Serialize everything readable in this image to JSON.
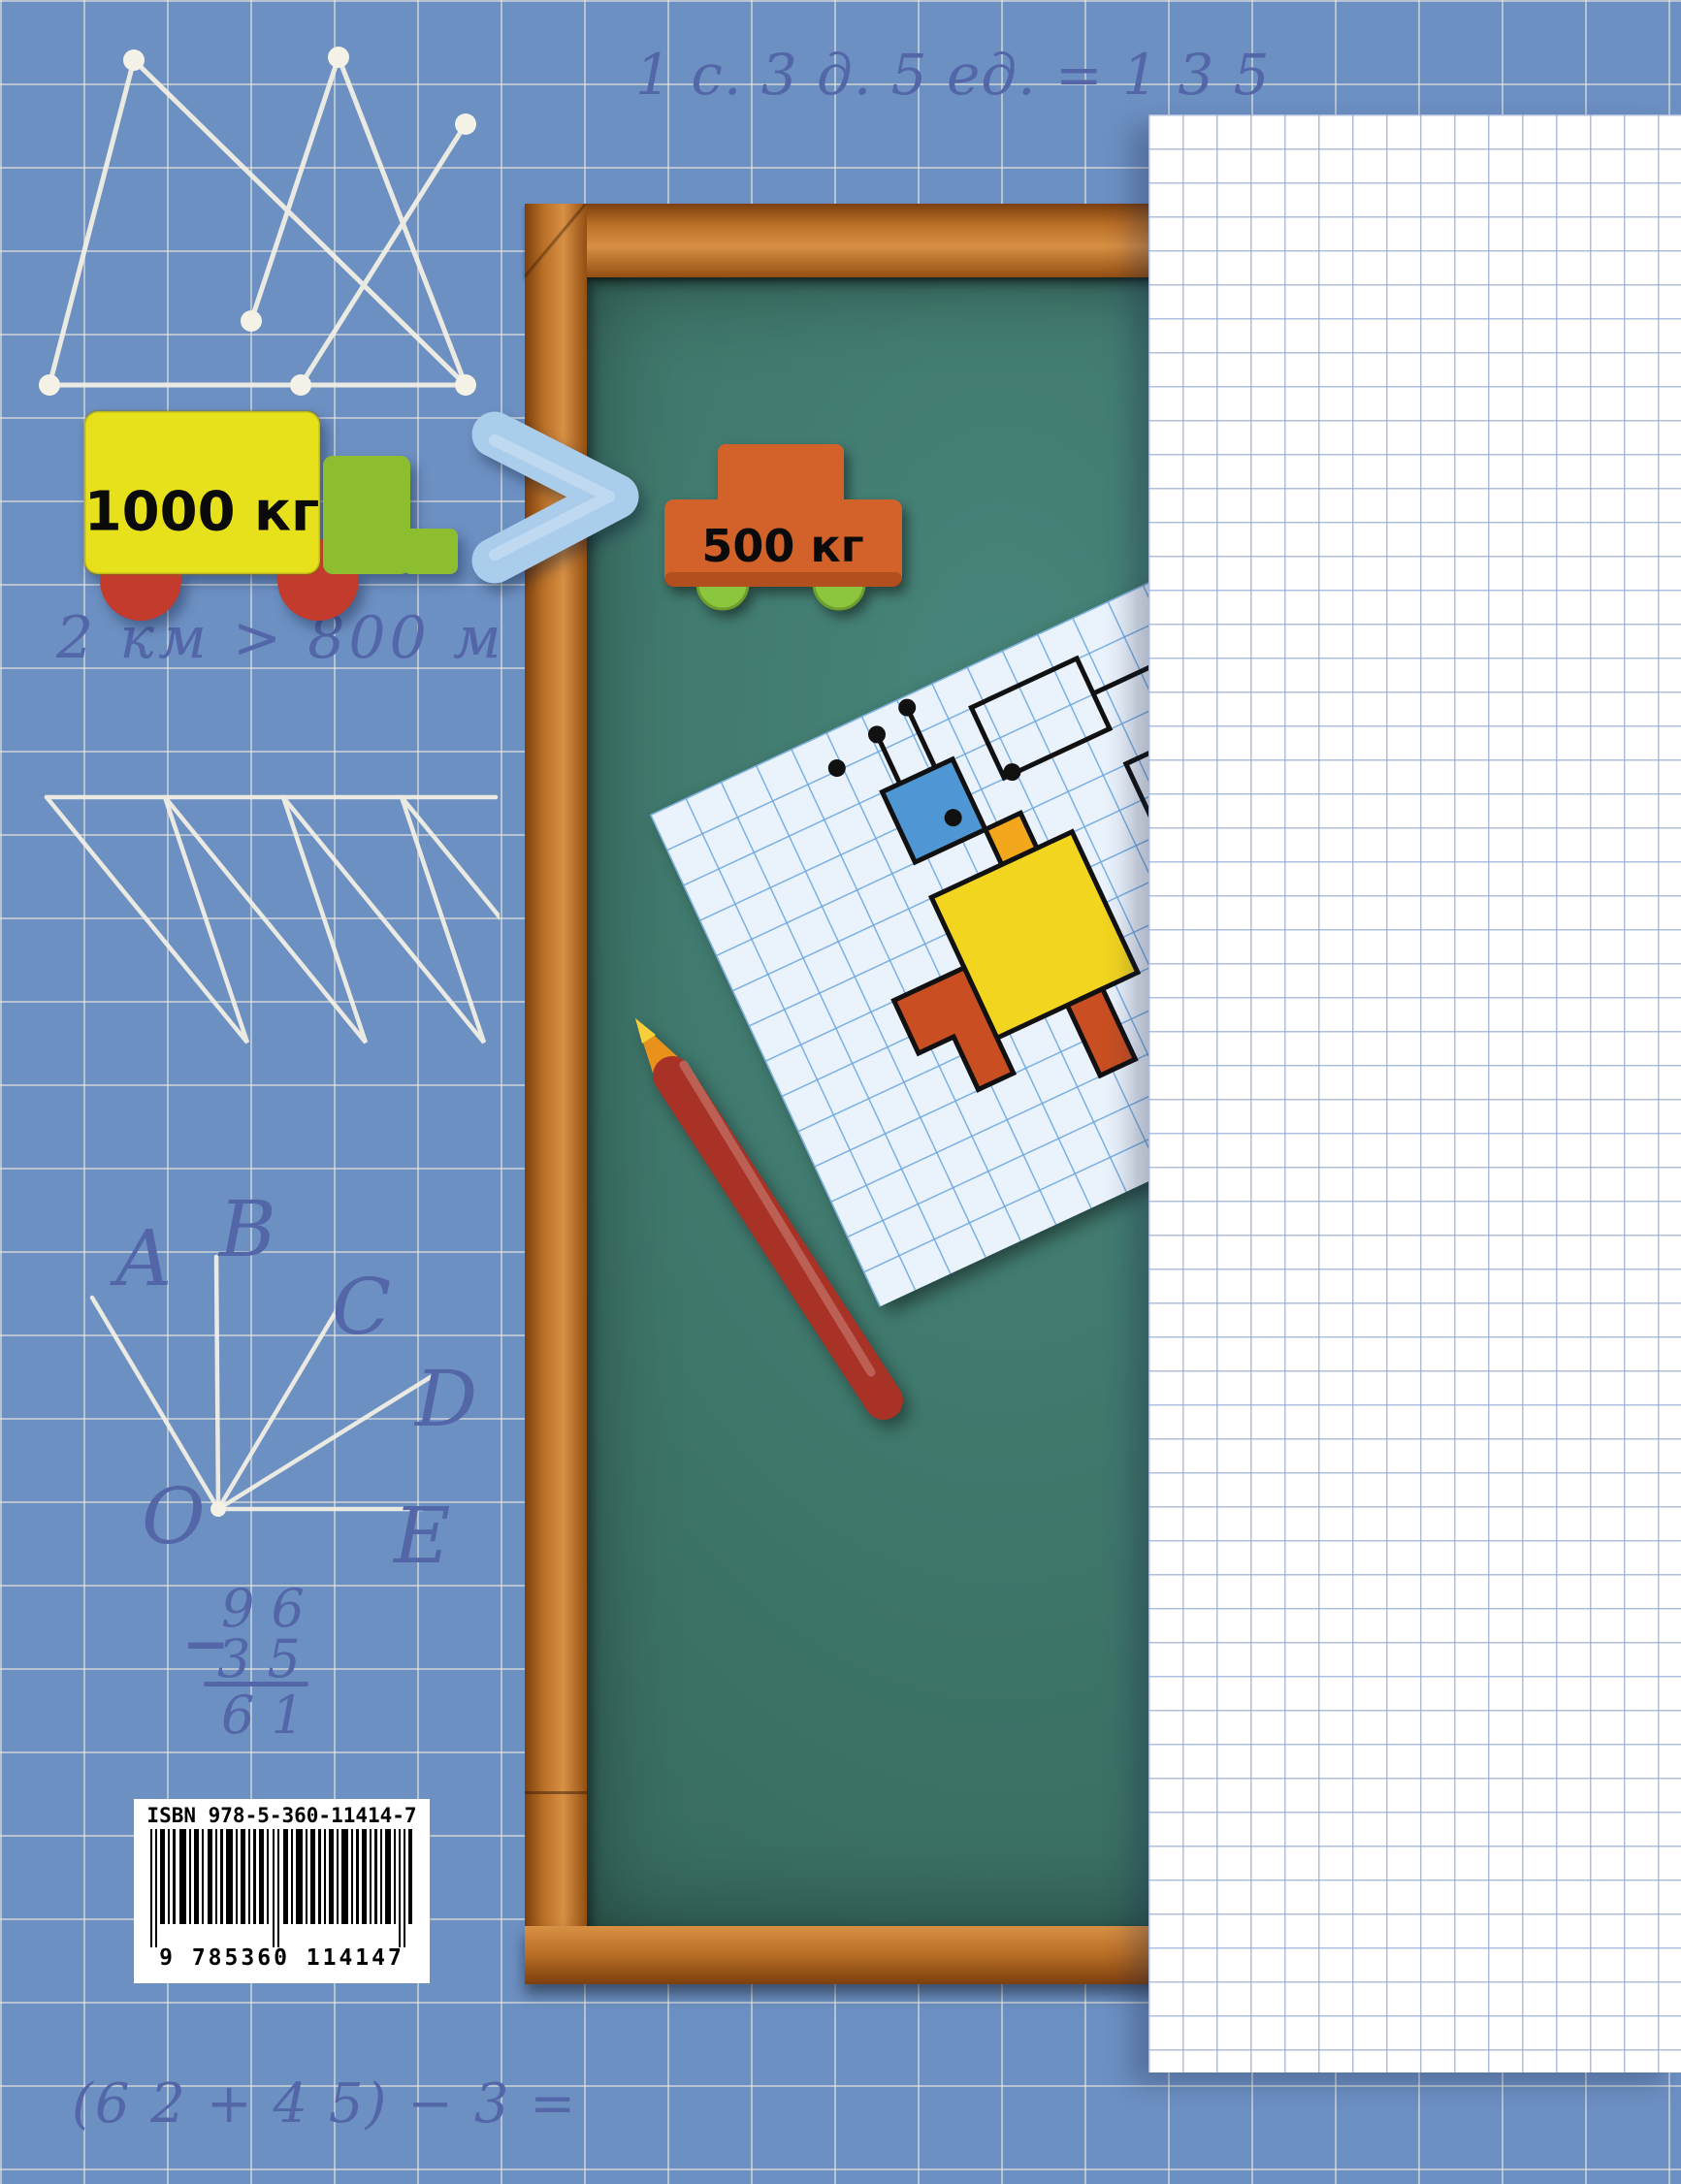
{
  "page": {
    "background_color": "#6d90c3",
    "grid_color": "#f3eede",
    "handwriting_color": "#5266a8"
  },
  "handwriting": {
    "top_equation": "1 с. 3 д. 5 ед. = 1 3 5",
    "km_comparison": "2 км > 800 м",
    "subtraction": {
      "minus_sign": "−",
      "minuend": "9 6",
      "subtrahend": "3 5",
      "difference": "6 1"
    },
    "bottom_expression": "(6 2 + 4 5) − 3 =",
    "ray_labels": [
      "А",
      "В",
      "С",
      "D",
      "О",
      "Е"
    ]
  },
  "magnets": {
    "big_truck": {
      "label": "1000 кг",
      "body_color": "#e7e11c",
      "cab_color": "#8cbe2f",
      "wheel_color": "#c23b2c"
    },
    "comparison_sign": ">",
    "small_truck": {
      "label": "500 кг",
      "body_color": "#d2622a",
      "wheel_color": "#8cc63e"
    }
  },
  "chalkboard": {
    "surface_color": "#3d7468",
    "frame_color": "#b96f26"
  },
  "sheet": {
    "paper_color": "#eaf2fc",
    "grid_color": "#68a5e0"
  },
  "isbn": {
    "label": "ISBN 978-5-360-11414-7",
    "digits": "9 785360 114147"
  },
  "panel": {
    "background": "#ffffff",
    "grid_color": "#94a9d2"
  }
}
